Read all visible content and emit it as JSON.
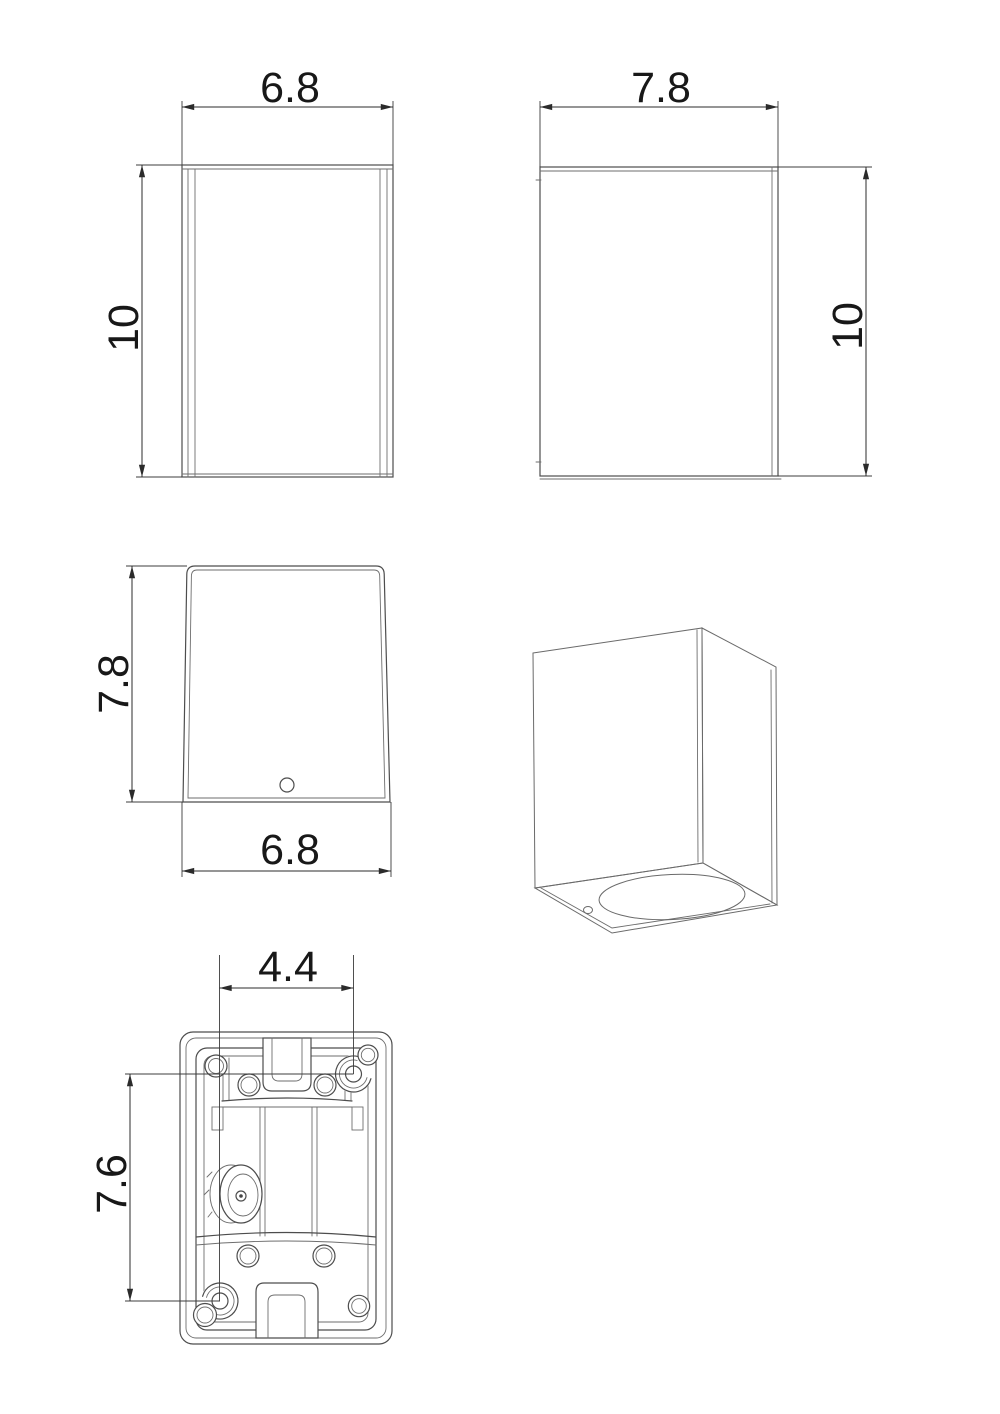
{
  "drawing": {
    "type": "technical-dimension-drawing",
    "subject": "rectangular wall luminaire",
    "colors": {
      "background": "#ffffff",
      "object_line": "#4d4d4d",
      "dimension_line": "#2b2b2b",
      "text": "#181818"
    },
    "front_view": {
      "width": "6.8",
      "height": "10"
    },
    "side_view": {
      "depth": "7.8",
      "height": "10"
    },
    "top_view": {
      "depth": "7.8",
      "width": "6.8"
    },
    "bottom_view": {
      "hole_spacing_x": "4.4",
      "hole_spacing_y": "7.6"
    }
  }
}
